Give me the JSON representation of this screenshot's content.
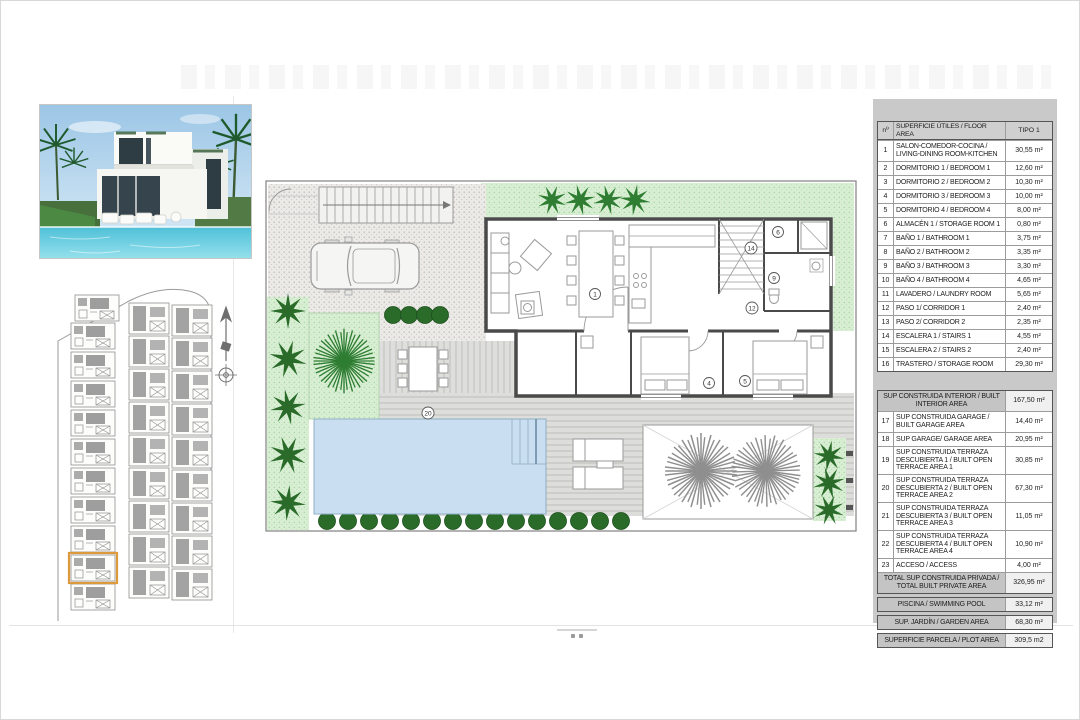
{
  "colors": {
    "accent_orange": "#dd9a3c",
    "garden_green": "#d7eed2",
    "bush_green": "#2a6b2a",
    "pool_blue": "#c9def0",
    "wall_gray": "#4a4a4a",
    "panel_gray": "#c9c9c9"
  },
  "floor_plan": {
    "room_numbers": {
      "r1": "1",
      "r4": "4",
      "r5": "5",
      "r6": "6",
      "r9": "9",
      "r12": "12",
      "r14": "14",
      "r20": "20"
    }
  },
  "area_table": {
    "header": {
      "num": "nº",
      "label": "SUPERFICIE ÚTILES / FLOOR AREA",
      "tipo": "TIPO 1"
    },
    "rows": [
      {
        "n": "1",
        "label": "SALON-COMEDOR-COCINA / LIVING-DINING ROOM-KITCHEN",
        "value": "30,55 m²"
      },
      {
        "n": "2",
        "label": "DORMITORIO 1 / BEDROOM 1",
        "value": "12,60 m²"
      },
      {
        "n": "3",
        "label": "DORMITORIO 2 / BEDROOM 2",
        "value": "10,30 m²"
      },
      {
        "n": "4",
        "label": "DORMITORIO 3 / BEDROOM 3",
        "value": "10,00 m²"
      },
      {
        "n": "5",
        "label": "DORMITORIO 4 / BEDROOM 4",
        "value": "8,00 m²"
      },
      {
        "n": "6",
        "label": "ALMACÉN 1 / STORAGE ROOM 1",
        "value": "0,80 m²"
      },
      {
        "n": "7",
        "label": "BAÑO 1 / BATHROOM 1",
        "value": "3,75 m²"
      },
      {
        "n": "8",
        "label": "BAÑO 2 / BATHROOM 2",
        "value": "3,35 m²"
      },
      {
        "n": "9",
        "label": "BAÑO 3 / BATHROOM 3",
        "value": "3,30 m²"
      },
      {
        "n": "10",
        "label": "BAÑO 4 / BATHROOM 4",
        "value": "4,65 m²"
      },
      {
        "n": "11",
        "label": "LAVADERO / LAUNDRY ROOM",
        "value": "5,65 m²"
      },
      {
        "n": "12",
        "label": "PASO 1/ CORRIDOR 1",
        "value": "2,40 m²"
      },
      {
        "n": "13",
        "label": "PASO 2/ CORRIDOR 2",
        "value": "2,35 m²"
      },
      {
        "n": "14",
        "label": "ESCALERA 1 / STAIRS 1",
        "value": "4,55 m²"
      },
      {
        "n": "15",
        "label": "ESCALERA 2 / STAIRS 2",
        "value": "2,40 m²"
      },
      {
        "n": "16",
        "label": "TRASTERO / STORAGE ROOM",
        "value": "29,30 m²"
      }
    ],
    "interior": {
      "label": "SUP CONSTRUIDA INTERIOR / BUILT INTERIOR AREA",
      "value": "167,50 m²"
    },
    "rows2": [
      {
        "n": "17",
        "label": "SUP CONSTRUIDA GARAGE / BUILT GARAGE AREA",
        "value": "14,40 m²"
      },
      {
        "n": "18",
        "label": "SUP GARAGE/ GARAGE AREA",
        "value": "20,95 m²"
      },
      {
        "n": "19",
        "label": "SUP CONSTRUIDA TERRAZA DESCUBIERTA 1 / BUILT OPEN TERRACE AREA 1",
        "value": "30,85 m²"
      },
      {
        "n": "20",
        "label": "SUP CONSTRUIDA TERRAZA DESCUBIERTA 2 / BUILT OPEN TERRACE AREA 2",
        "value": "67,30 m²"
      },
      {
        "n": "21",
        "label": "SUP CONSTRUIDA TERRAZA DESCUBIERTA 3 / BUILT OPEN TERRACE AREA 3",
        "value": "11,05 m²"
      },
      {
        "n": "22",
        "label": "SUP CONSTRUIDA TERRAZA DESCUBIERTA 4 / BUILT OPEN TERRACE AREA 4",
        "value": "10,90 m²"
      },
      {
        "n": "23",
        "label": "ACCESO / ACCESS",
        "value": "4,00 m²"
      }
    ],
    "total": {
      "label": "TOTAL SUP CONSTRUIDA PRIVADA / TOTAL BUILT PRIVATE AREA",
      "value": "326,95 m²"
    },
    "pool": {
      "label": "PISCINA / SWIMMING POOL",
      "value": "33,12 m²"
    },
    "garden": {
      "label": "SUP. JARDÍN / GARDEN AREA",
      "value": "68,30 m²"
    },
    "plot": {
      "label": "SUPERFICIE PARCELA / PLOT AREA",
      "value": "309,5 m2"
    }
  }
}
